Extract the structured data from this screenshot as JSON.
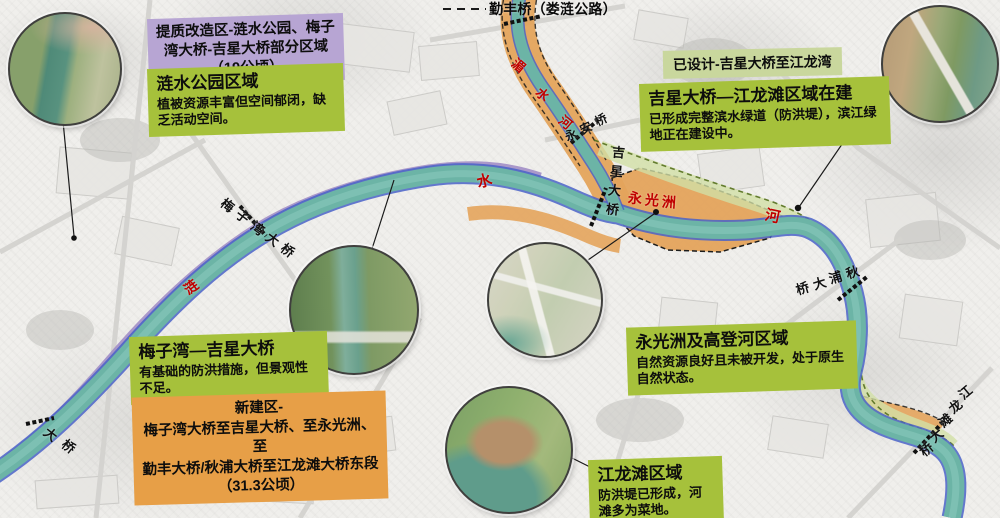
{
  "callouts": {
    "renovation_zone": {
      "lines": [
        "提质改造区-涟水公园、梅子",
        "湾大桥-吉星大桥部分区域",
        "（19公顷）"
      ]
    },
    "lianshui_park": {
      "title": "涟水公园区域",
      "body": "植被资源丰富但空间郁闭，缺乏活动空间。"
    },
    "designed": {
      "text": "已设计-吉星大桥至江龙湾"
    },
    "jixing_jianglongtan": {
      "title": "吉星大桥—江龙滩区域在建",
      "body": "已形成完整滨水绿道（防洪堤），滨江绿地正在建设中。"
    },
    "meiziwan_jixing": {
      "title": "梅子湾—吉星大桥",
      "body": "有基础的防洪措施，但景观性不足。"
    },
    "new_zone": {
      "lines": [
        "新建区-",
        "梅子湾大桥至吉星大桥、至永光洲、至",
        "勤丰大桥/秋浦大桥至江龙滩大桥东段",
        "（31.3公顷）"
      ]
    },
    "yongguangzhou_gaodenghe": {
      "title": "永光洲及高登河区域",
      "body": "自然资源良好且未被开发，处于原生自然状态。"
    },
    "jianglongtan": {
      "title": "江龙滩区域",
      "body": "防洪堤已形成，河滩多为菜地。"
    }
  },
  "map_labels": [
    {
      "name": "qinfeng-bridge",
      "text": "勤丰桥（娄涟公路）",
      "x": 489,
      "y": 2,
      "sx": 14.2,
      "sy": 0,
      "rot": 0,
      "size": 14,
      "color": "#0a0a0a"
    },
    {
      "name": "meishui-river",
      "text": "湄水河",
      "x": 512,
      "y": 59,
      "sx": 23.5,
      "sy": 28.5,
      "rot": 40,
      "size": 13,
      "color": "#c00000"
    },
    {
      "name": "river-char-lian",
      "text": "涟",
      "x": 184,
      "y": 280,
      "sx": 0,
      "sy": 0,
      "rot": -36,
      "size": 14,
      "color": "#c00000"
    },
    {
      "name": "river-char-shui",
      "text": "水",
      "x": 477,
      "y": 174,
      "sx": 0,
      "sy": 0,
      "rot": -15,
      "size": 15,
      "color": "#c00000"
    },
    {
      "name": "river-char-he",
      "text": "河",
      "x": 765,
      "y": 209,
      "sx": 0,
      "sy": 0,
      "rot": 12,
      "size": 15,
      "color": "#c00000"
    },
    {
      "name": "yongguangzhou",
      "text": "永光洲",
      "x": 628,
      "y": 191,
      "sx": 17,
      "sy": 2,
      "rot": 4,
      "size": 14,
      "color": "#c00000"
    },
    {
      "name": "yongan-bridge",
      "text": "永安桥",
      "x": 565,
      "y": 129,
      "sx": 15,
      "sy": -7.5,
      "rot": -26,
      "size": 12,
      "color": "#111111"
    },
    {
      "name": "jixing-bridge",
      "text": "吉星大桥",
      "x": 612,
      "y": 146,
      "sx": -2,
      "sy": 19,
      "rot": 5,
      "size": 13,
      "color": "#111111"
    },
    {
      "name": "meiziwan-bridge",
      "text": "梅子湾大桥",
      "x": 221,
      "y": 199,
      "sx": 15,
      "sy": 11.3,
      "rot": 37,
      "size": 13,
      "color": "#111111"
    },
    {
      "name": "qiupu-bridge",
      "text": "秋浦大桥",
      "x": 846,
      "y": 266,
      "sx": -16.6,
      "sy": 5.3,
      "rot": -17,
      "size": 13,
      "color": "#111111"
    },
    {
      "name": "jianglongtan-bridge",
      "text": "江龙滩大桥",
      "x": 959,
      "y": 386,
      "sx": -9.8,
      "sy": 14.2,
      "rot": -40,
      "size": 13,
      "color": "#111111"
    },
    {
      "name": "partial-bridge",
      "text": "大桥",
      "x": 44,
      "y": 428,
      "sx": 18,
      "sy": 12,
      "rot": 38,
      "size": 13,
      "color": "#111111"
    }
  ],
  "colors": {
    "green_box": "#a6c13b",
    "light_green_label": "#c9d79d",
    "purple_box": "#b7a5d3",
    "orange_box": "#e79f47",
    "river": "#6cb4a6",
    "river_edge": "#4a63c8",
    "zone_orange": "#e4a45c",
    "zone_purple": "#9d88c4",
    "zone_green": "#d2e0a6",
    "river_text_red": "#c00000"
  }
}
